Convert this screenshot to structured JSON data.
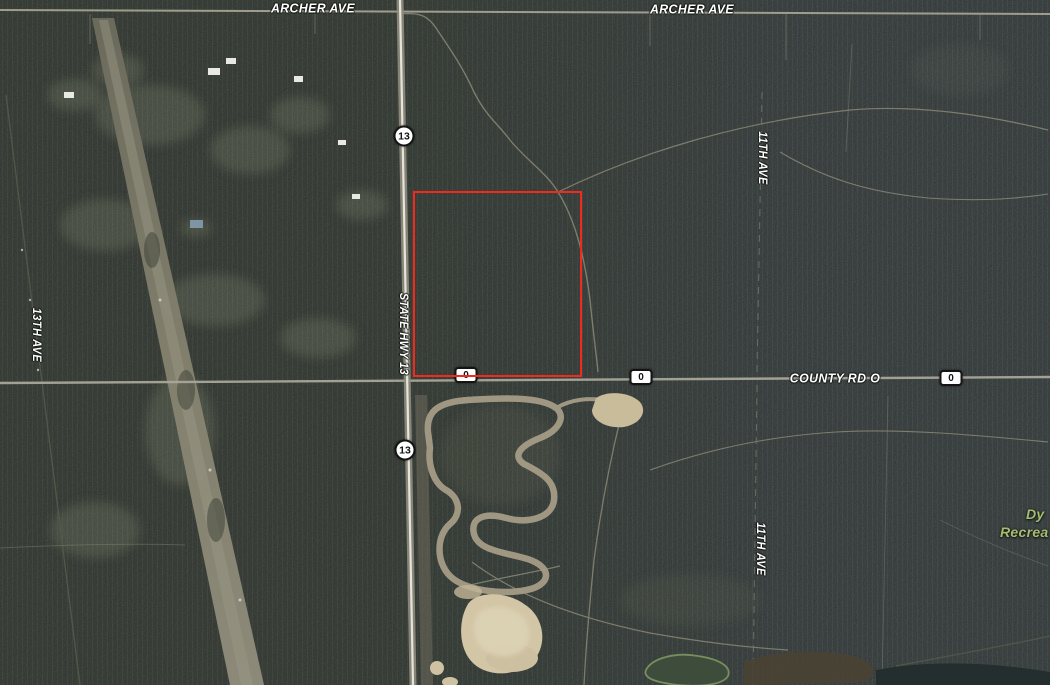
{
  "map": {
    "view": "satellite-aerial",
    "labels": {
      "archer_ave_west": "ARCHER AVE",
      "archer_ave_east": "ARCHER AVE",
      "county_rd_o": "COUNTY RD O",
      "state_hwy_13": "STATE HWY 13",
      "thirteenth_ave": "13TH AVE",
      "eleventh_ave_north": "11TH AVE",
      "eleventh_ave_south": "11TH AVE",
      "poi_green_line1": "Dy",
      "poi_green_line2": "Recrea"
    },
    "markers": {
      "hwy13_shield_north": "13",
      "hwy13_shield_south": "13",
      "county_badge_west": "0",
      "county_badge_mid": "0",
      "county_badge_east": "0"
    },
    "boundary": {
      "x": 413,
      "y": 191,
      "width": 169,
      "height": 186,
      "color": "#f3291b"
    },
    "colors": {
      "forest_dark": "#212722",
      "forest_blue": "#262c33",
      "road_gray": "#a8a699",
      "highway_core": "#e6e4da",
      "sand": "#d2c6a6",
      "label_text": "#ffffff",
      "poi_green": "#a5bc72",
      "boundary_red": "#f3291b"
    }
  }
}
